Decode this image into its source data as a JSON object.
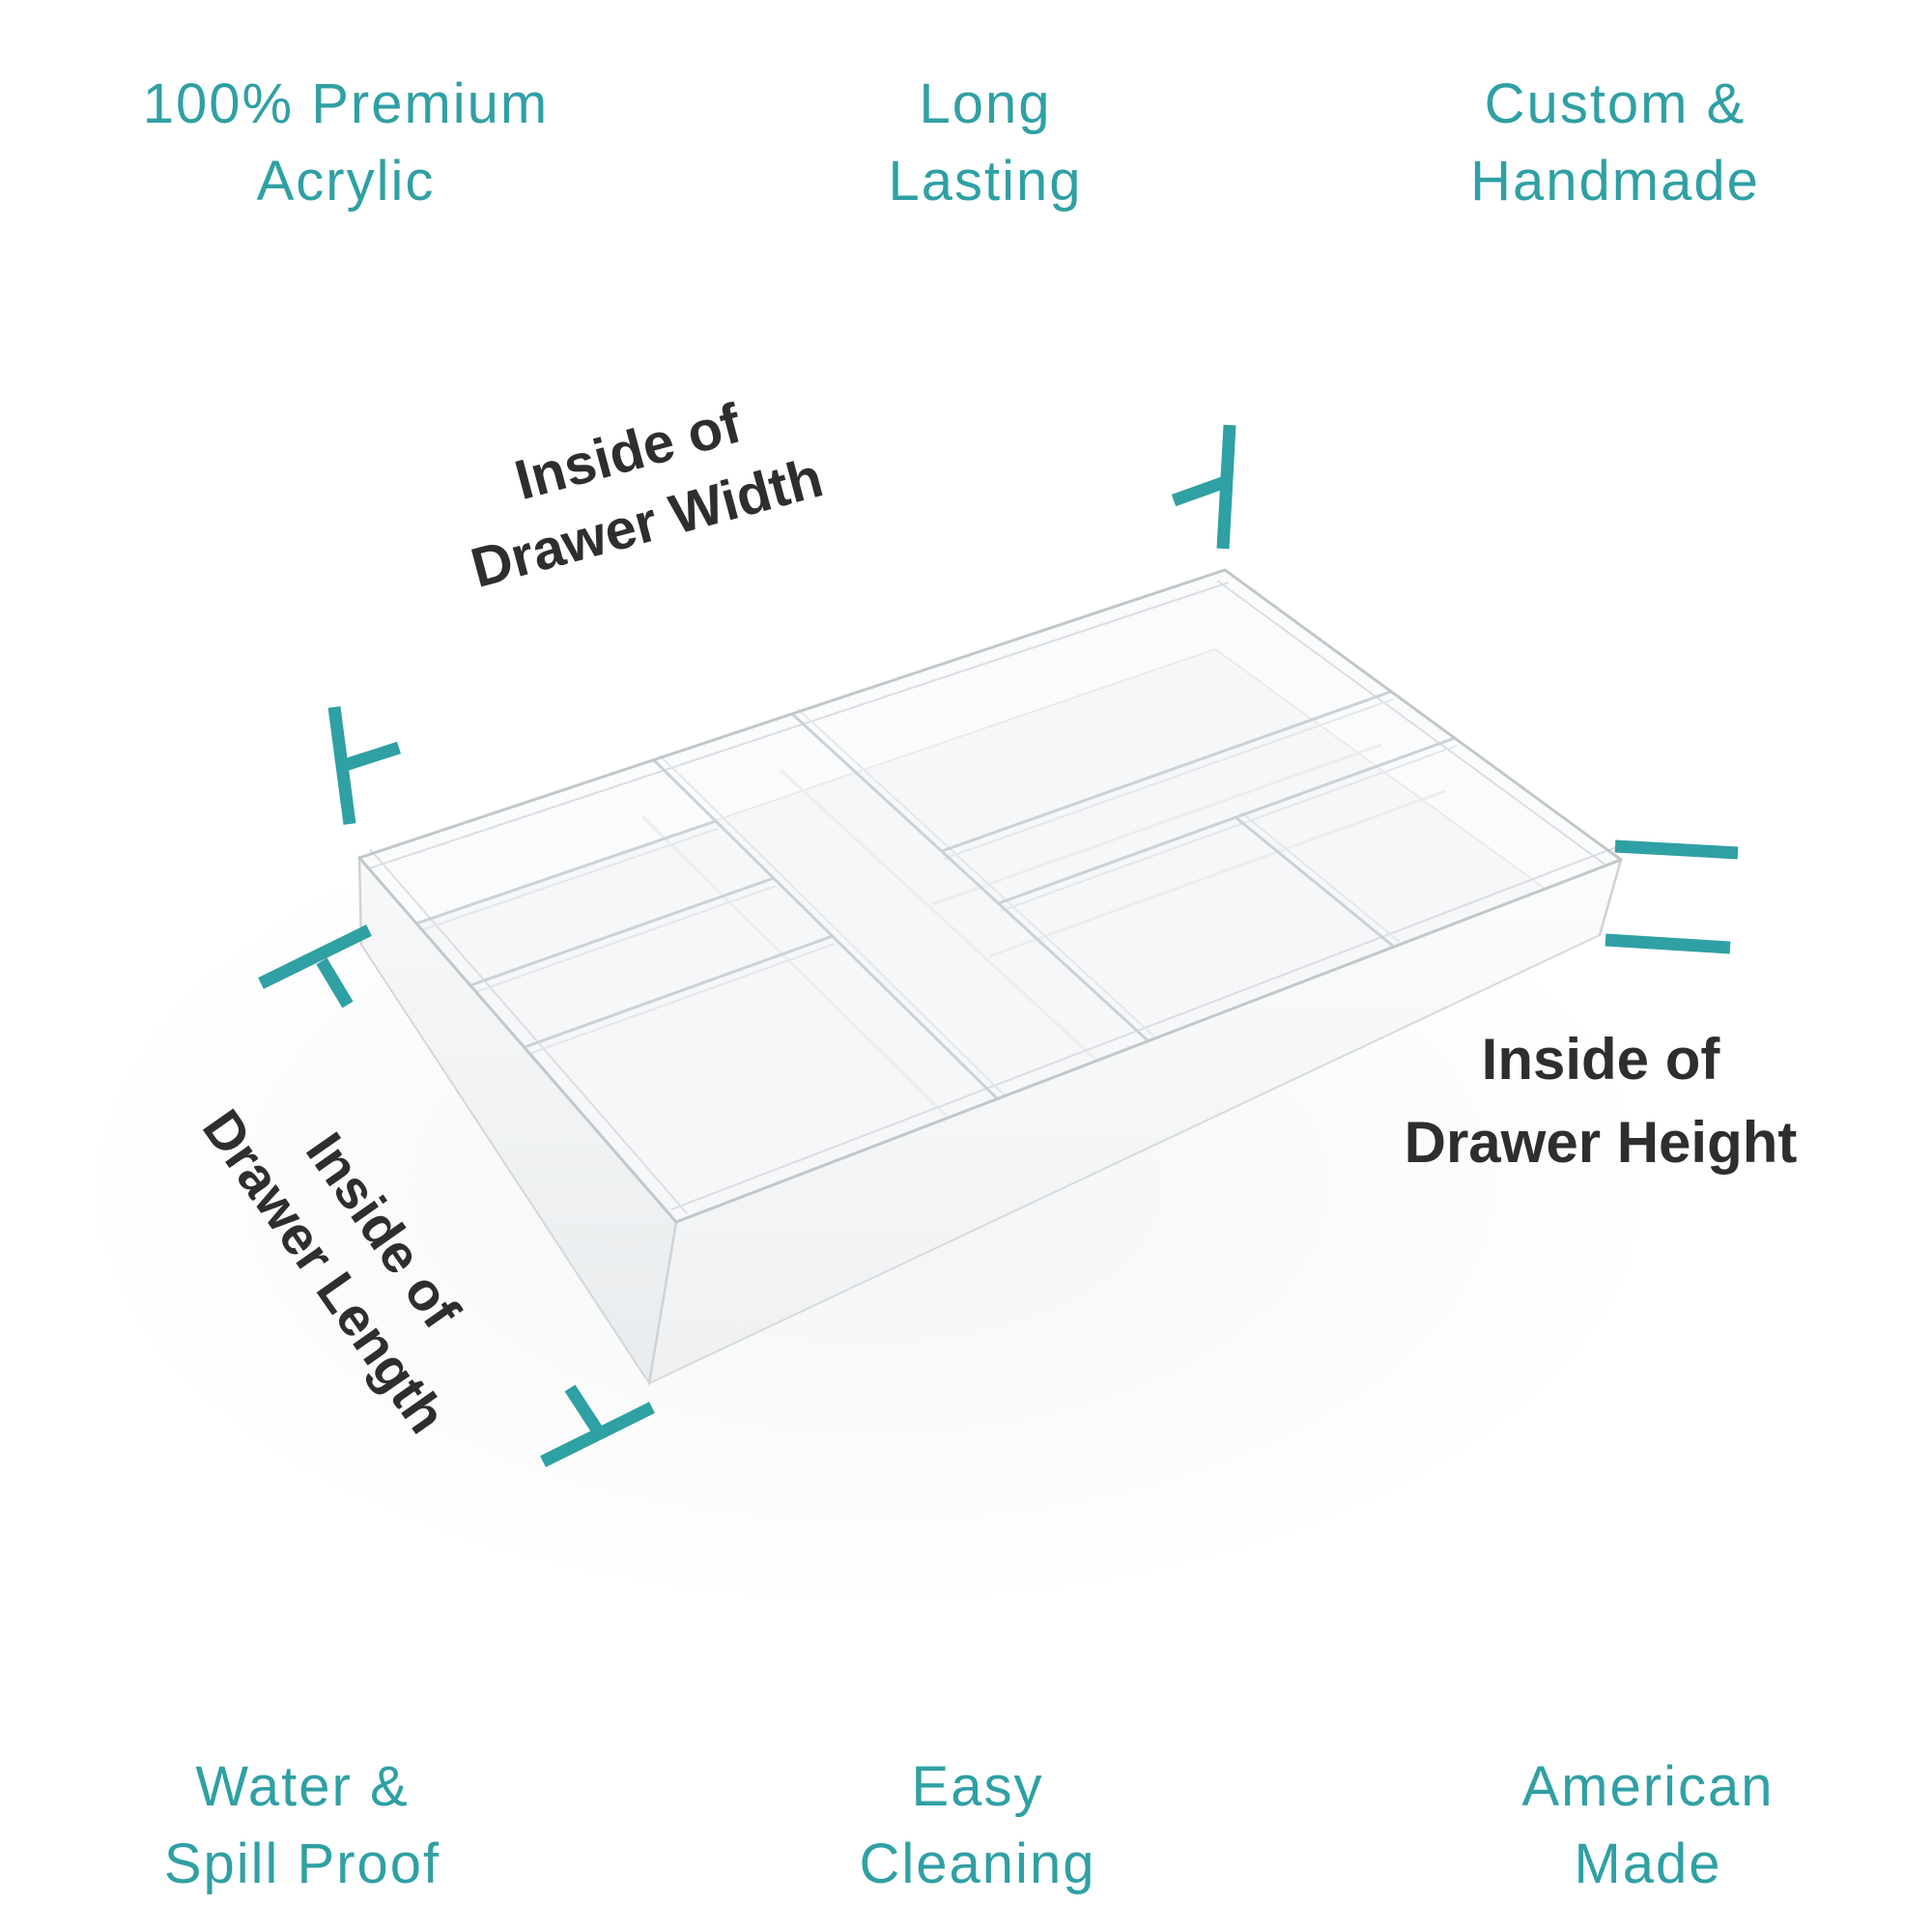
{
  "colors": {
    "accent": "#2FA0A4",
    "label_text": "#2E2E2E",
    "background": "#FFFFFF"
  },
  "features": [
    {
      "id": "premium-acrylic",
      "line1": "100% Premium",
      "line2": "Acrylic"
    },
    {
      "id": "long-lasting",
      "line1": "Long",
      "line2": "Lasting"
    },
    {
      "id": "custom-handmade",
      "line1": "Custom &",
      "line2": "Handmade"
    },
    {
      "id": "water-spill-proof",
      "line1": "Water &",
      "line2": "Spill Proof"
    },
    {
      "id": "easy-cleaning",
      "line1": "Easy",
      "line2": "Cleaning"
    },
    {
      "id": "american-made",
      "line1": "American",
      "line2": "Made"
    }
  ],
  "dimension_labels": {
    "width": {
      "line1": "Inside of",
      "line2": "Drawer Width"
    },
    "length": {
      "line1": "Inside of",
      "line2": "Drawer Length"
    },
    "height": {
      "line1": "Inside of",
      "line2": "Drawer Height"
    }
  },
  "illustration": {
    "description": "Clear acrylic drawer organizer tray with multiple compartments, 3D perspective view"
  }
}
